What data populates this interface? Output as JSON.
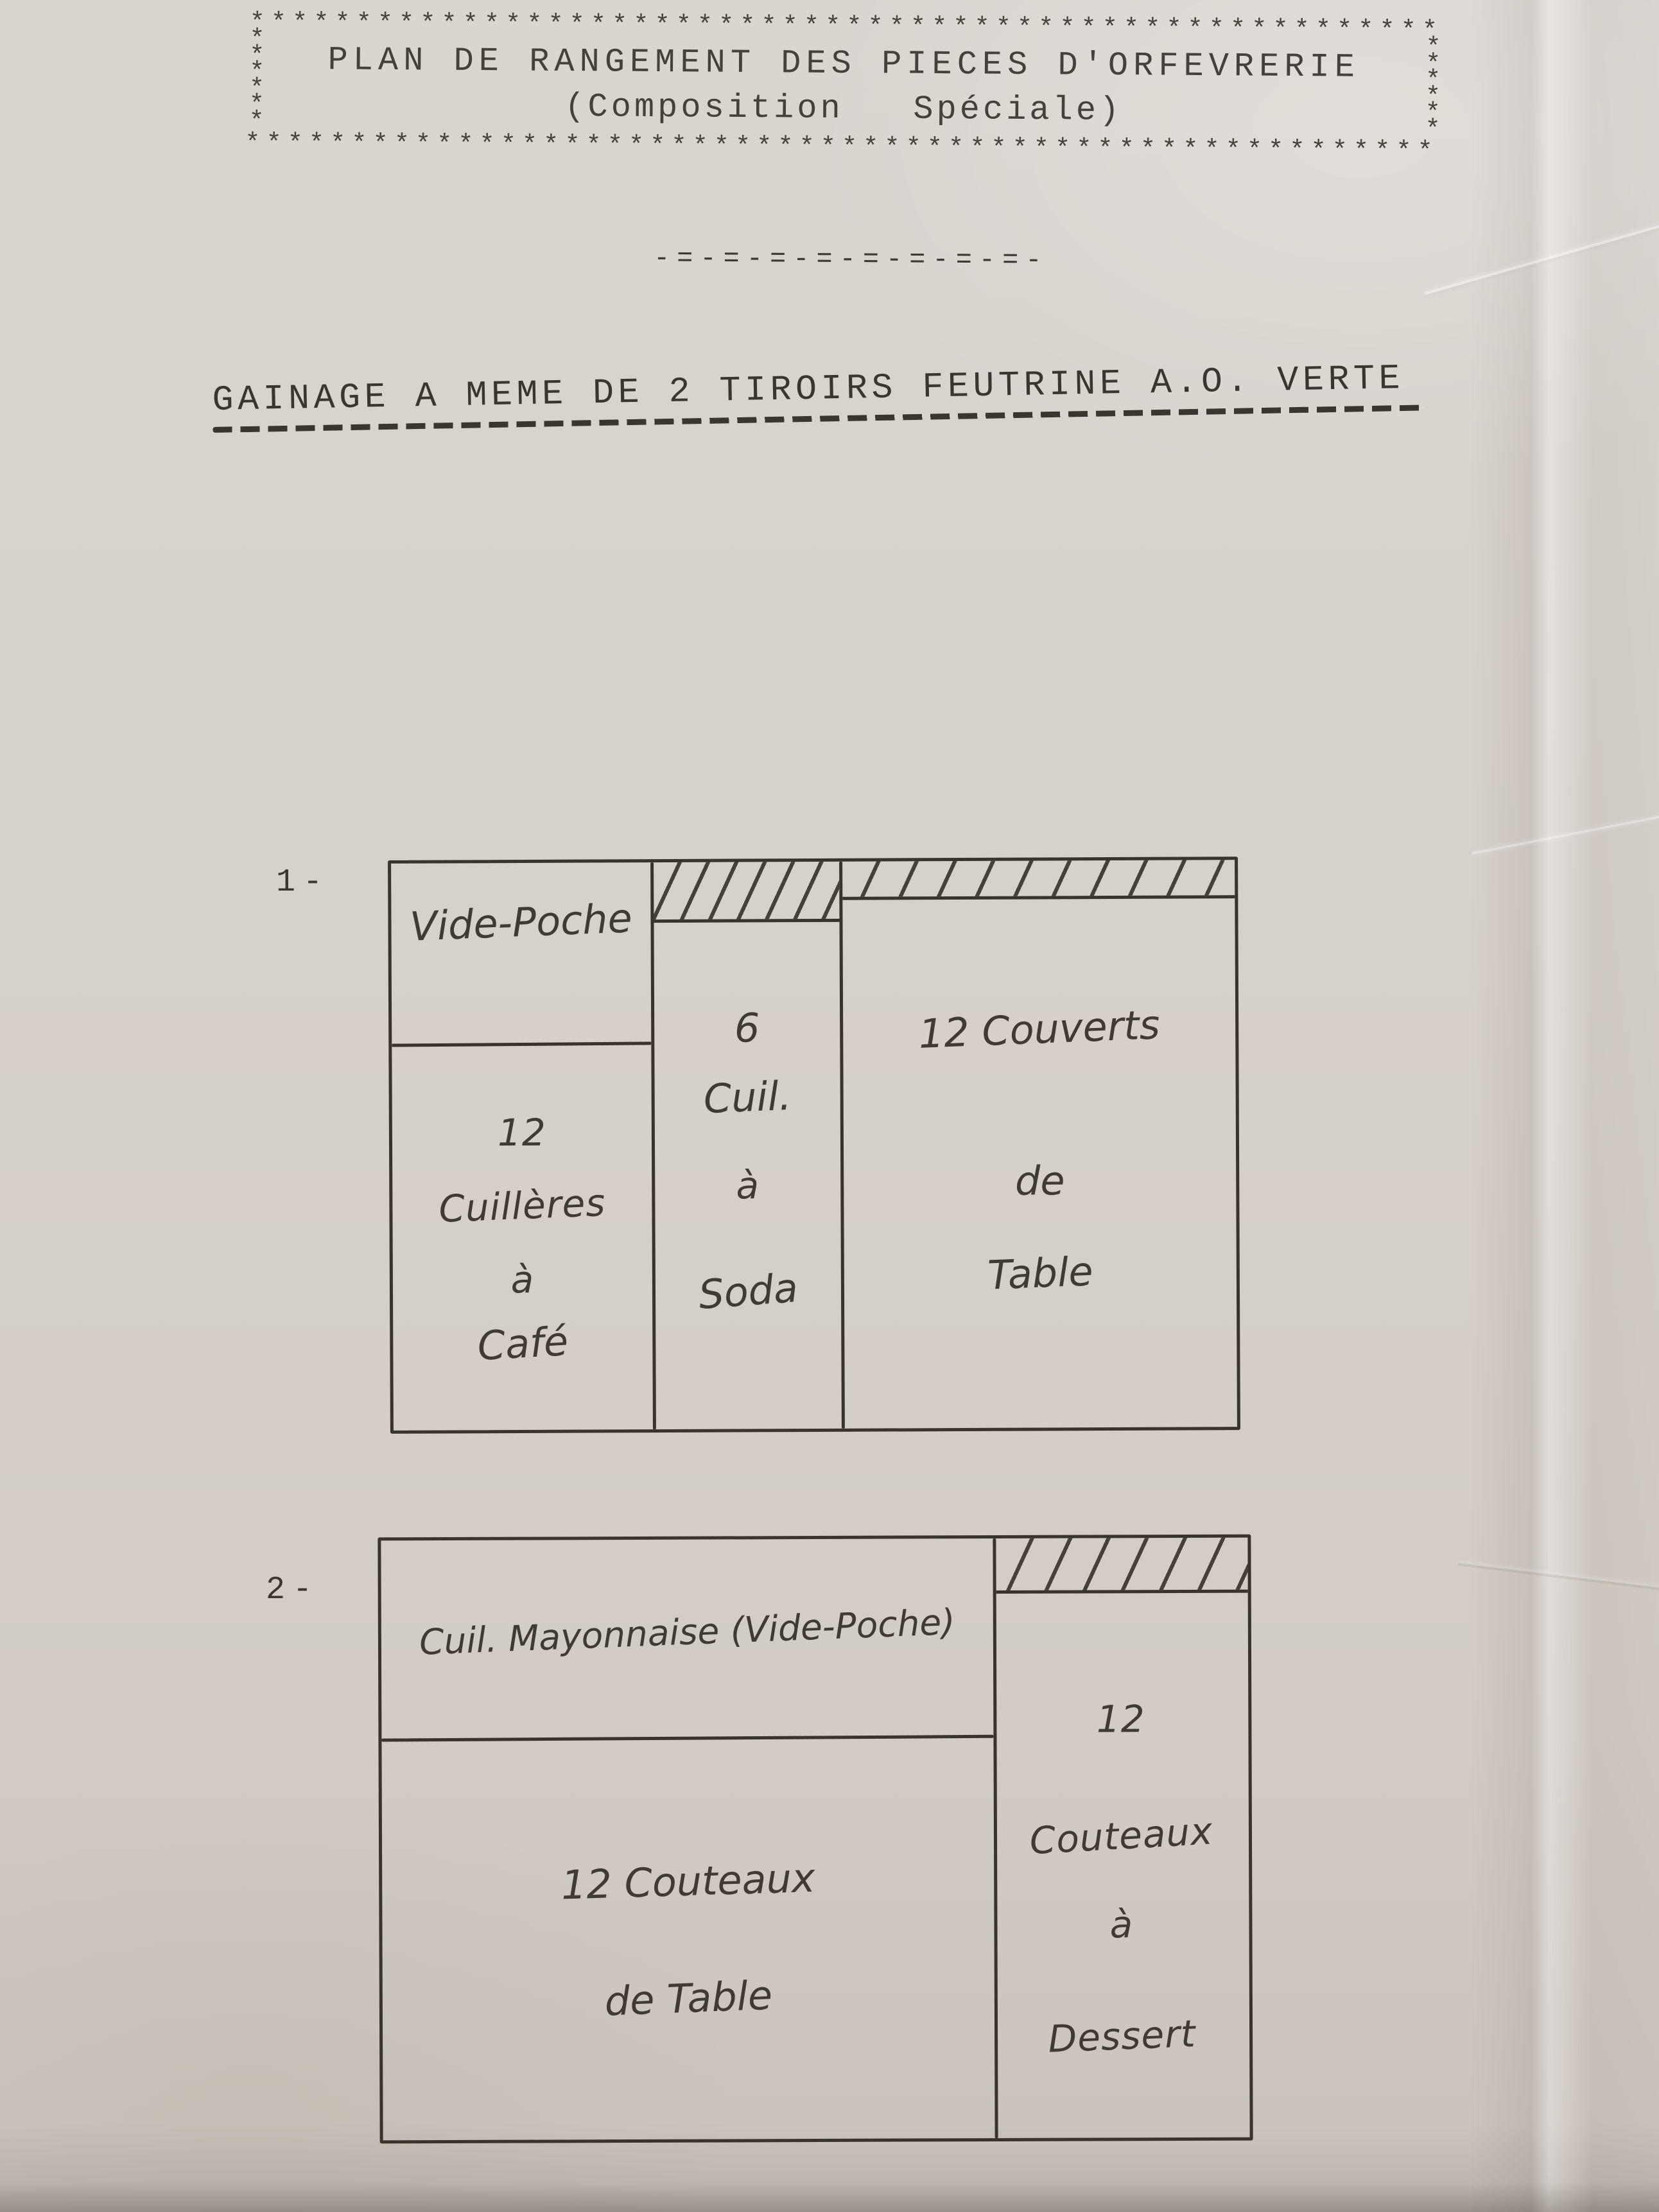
{
  "colors": {
    "paper": "#d6d1ca",
    "typed_ink": "#3b372f",
    "hand_ink": "#3f3b33"
  },
  "header_box": {
    "border_top": "********************************************************",
    "border_bottom": "********************************************************",
    "border_left": "*\n*\n*\n*\n*\n*",
    "border_right": "*\n*\n*\n*\n*\n*",
    "title": "PLAN DE RANGEMENT DES PIECES D'ORFEVRERIE",
    "subtitle": "(Composition   Spéciale)"
  },
  "separator": "-=-=-=-=-=-=-=-=-",
  "section_heading": "GAINAGE A MEME DE 2 TIROIRS FEUTRINE A.O. VERTE",
  "drawer1": {
    "label": "1-",
    "vide_poche": "Vide-Poche",
    "cafe": {
      "qty": "12",
      "w1": "Cuillères",
      "w2": "à",
      "w3": "Café"
    },
    "soda": {
      "qty": "6",
      "w1": "Cuil.",
      "w2": "à",
      "w3": "Soda"
    },
    "couverts": {
      "l1": "12 Couverts",
      "l2": "de",
      "l3": "Table"
    }
  },
  "drawer2": {
    "label": "2-",
    "strip": "Cuil. Mayonnaise (Vide-Poche)",
    "table": {
      "l1": "12 Couteaux",
      "l2": "de Table"
    },
    "dessert": {
      "l1": "12",
      "l2": "Couteaux",
      "l3": "à",
      "l4": "Dessert"
    }
  }
}
